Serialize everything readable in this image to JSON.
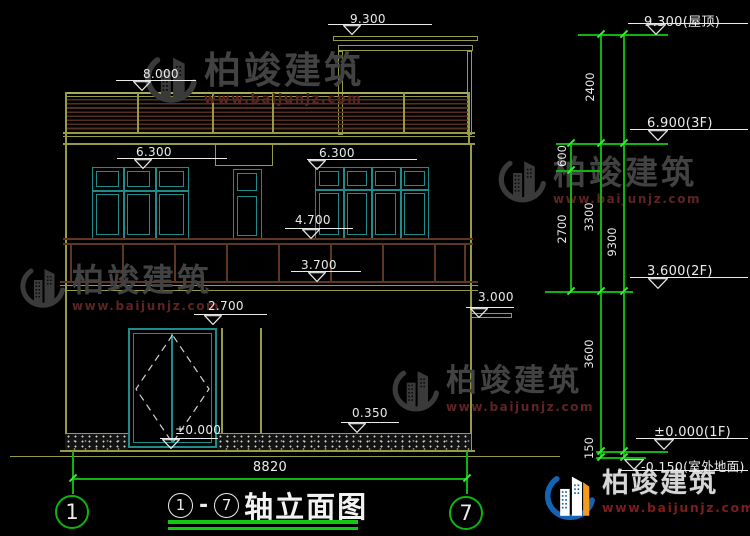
{
  "drawing": {
    "type": "building-elevation",
    "left_marks": {
      "v9300": "9.300",
      "v8000": "8.000",
      "v6300l": "6.300",
      "v6300r": "6.300",
      "v4700": "4.700",
      "v3700": "3.700",
      "v3000": "3.000",
      "v2700": "2.700",
      "v0350": "0.350",
      "v0000": "±0.000"
    },
    "right_marks": {
      "roof": "9.300(屋顶)",
      "f3": "6.900(3F)",
      "f2": "3.600(2F)",
      "f1": "±0.000(1F)",
      "ground": "-0.150(室外地面)"
    },
    "chain": {
      "d2400": "2400",
      "d600": "600",
      "d2700": "2700",
      "d3300": "3300",
      "d9300": "9300",
      "d3600": "3600",
      "d150": "150"
    },
    "axis": {
      "left": "1",
      "right": "7",
      "span": "8820"
    }
  },
  "title_block": {
    "from": "1",
    "dash": "-",
    "to": "7",
    "name": "轴立面图"
  },
  "watermark": {
    "name": "柏竣建筑",
    "url": "www.baijunjz.com"
  },
  "colors": {
    "background": "#000000",
    "outline_olive": "#979b44",
    "window_teal": "#1f8c8c",
    "railing_brown": "#553021",
    "dimension_green": "#0db40d",
    "text_white": "#e9ece9",
    "watermark_gray": "#424242",
    "watermark_red": "#5e2323",
    "logo_blue": "#1463b4",
    "logo_orange": "#f59b1e"
  }
}
